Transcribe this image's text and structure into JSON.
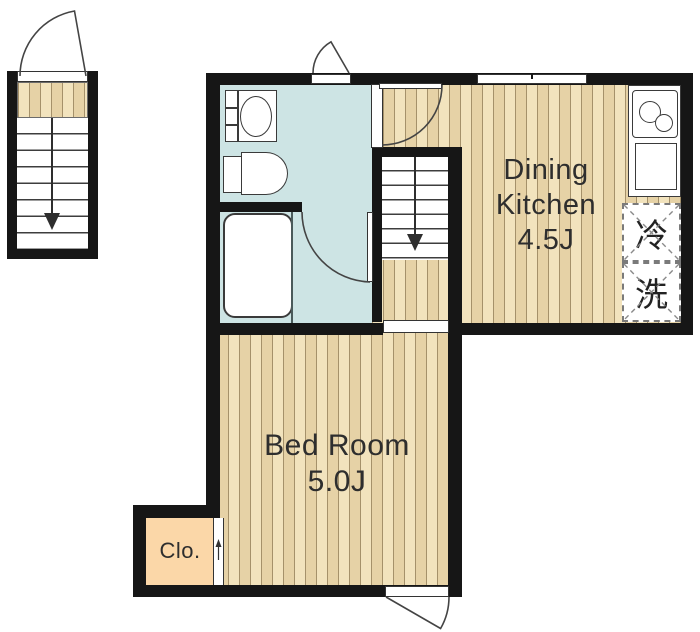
{
  "floorplan": {
    "rooms": {
      "dining_kitchen": {
        "label_line1": "Dining",
        "label_line2": "Kitchen",
        "area": "4.5J"
      },
      "bed_room": {
        "label_line1": "Bed Room",
        "area": "5.0J"
      },
      "closet": {
        "label": "Clo."
      }
    },
    "appliance_slots": {
      "refrigerator": "冷",
      "washing_machine": "洗"
    },
    "colors": {
      "wall": "#161616",
      "wood_floor": "#ecd9ae",
      "wet_area": "#cde4e4",
      "closet_fill": "#fbd7a8",
      "text": "#2e2e2e"
    }
  }
}
